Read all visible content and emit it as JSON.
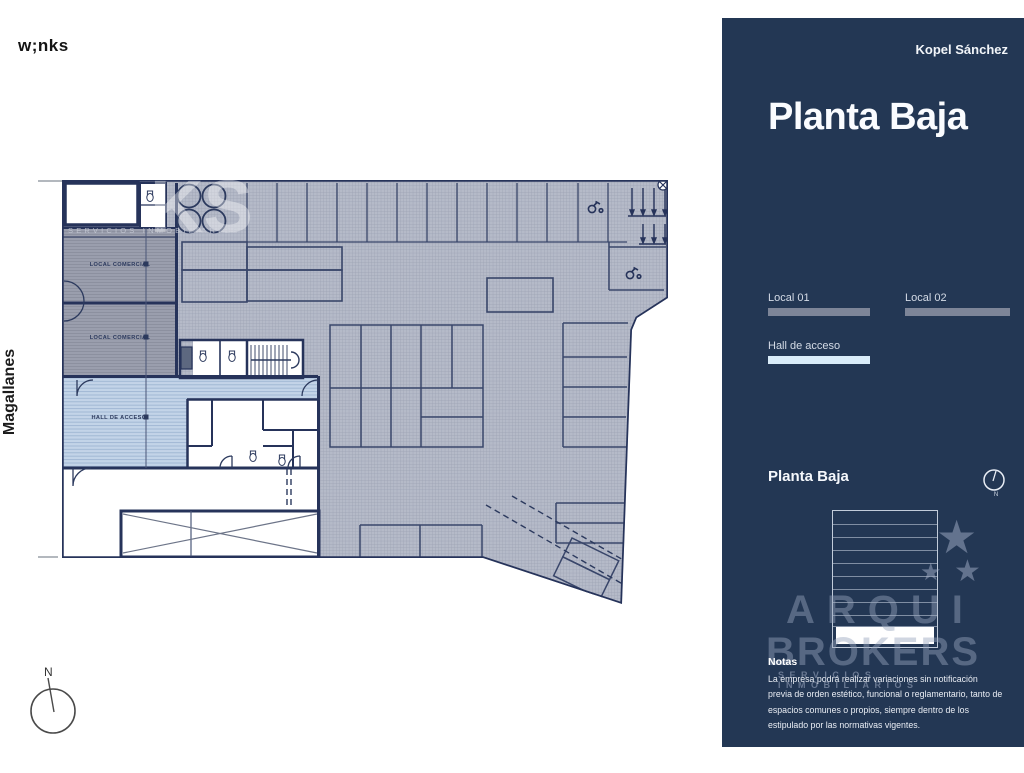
{
  "header": {
    "logo": "w;nks",
    "client": "Kopel Sánchez"
  },
  "sidebar": {
    "title": "Planta Baja",
    "legend": [
      {
        "label": "Local 01",
        "color": "#7d8598"
      },
      {
        "label": "Local 02",
        "color": "#7d8598"
      },
      {
        "label": "Hall de acceso",
        "color": "#d9ecf9"
      }
    ],
    "section_title": "Planta Baja",
    "compass_label": "N",
    "watermark": {
      "line1": "ARQUI",
      "line2": "BROKERS",
      "tagline": "SERVICIOS INMOBILIARIOS",
      "star": "★"
    },
    "notes_title": "Notas",
    "notes_body": "La empresa podrá realizar variaciones sin notificación previa de orden estético, funcional o reglamentario, tanto de espacios comunes o propios, siempre dentro de los estipulado por las normativas vigentes.",
    "colors": {
      "background": "#233754",
      "swatch_gray": "#7d8598",
      "swatch_blue": "#d9ecf9"
    }
  },
  "plan": {
    "street": "Magallanes",
    "rooms": {
      "local1": "LOCAL COMERCIAL",
      "local2": "LOCAL COMERCIAL",
      "hall": "HALL DE ACCESO"
    },
    "compass_label": "N",
    "watermark_letters": "KS",
    "watermark_tagline": "SERVICIOS INMOBILIARIOS"
  }
}
